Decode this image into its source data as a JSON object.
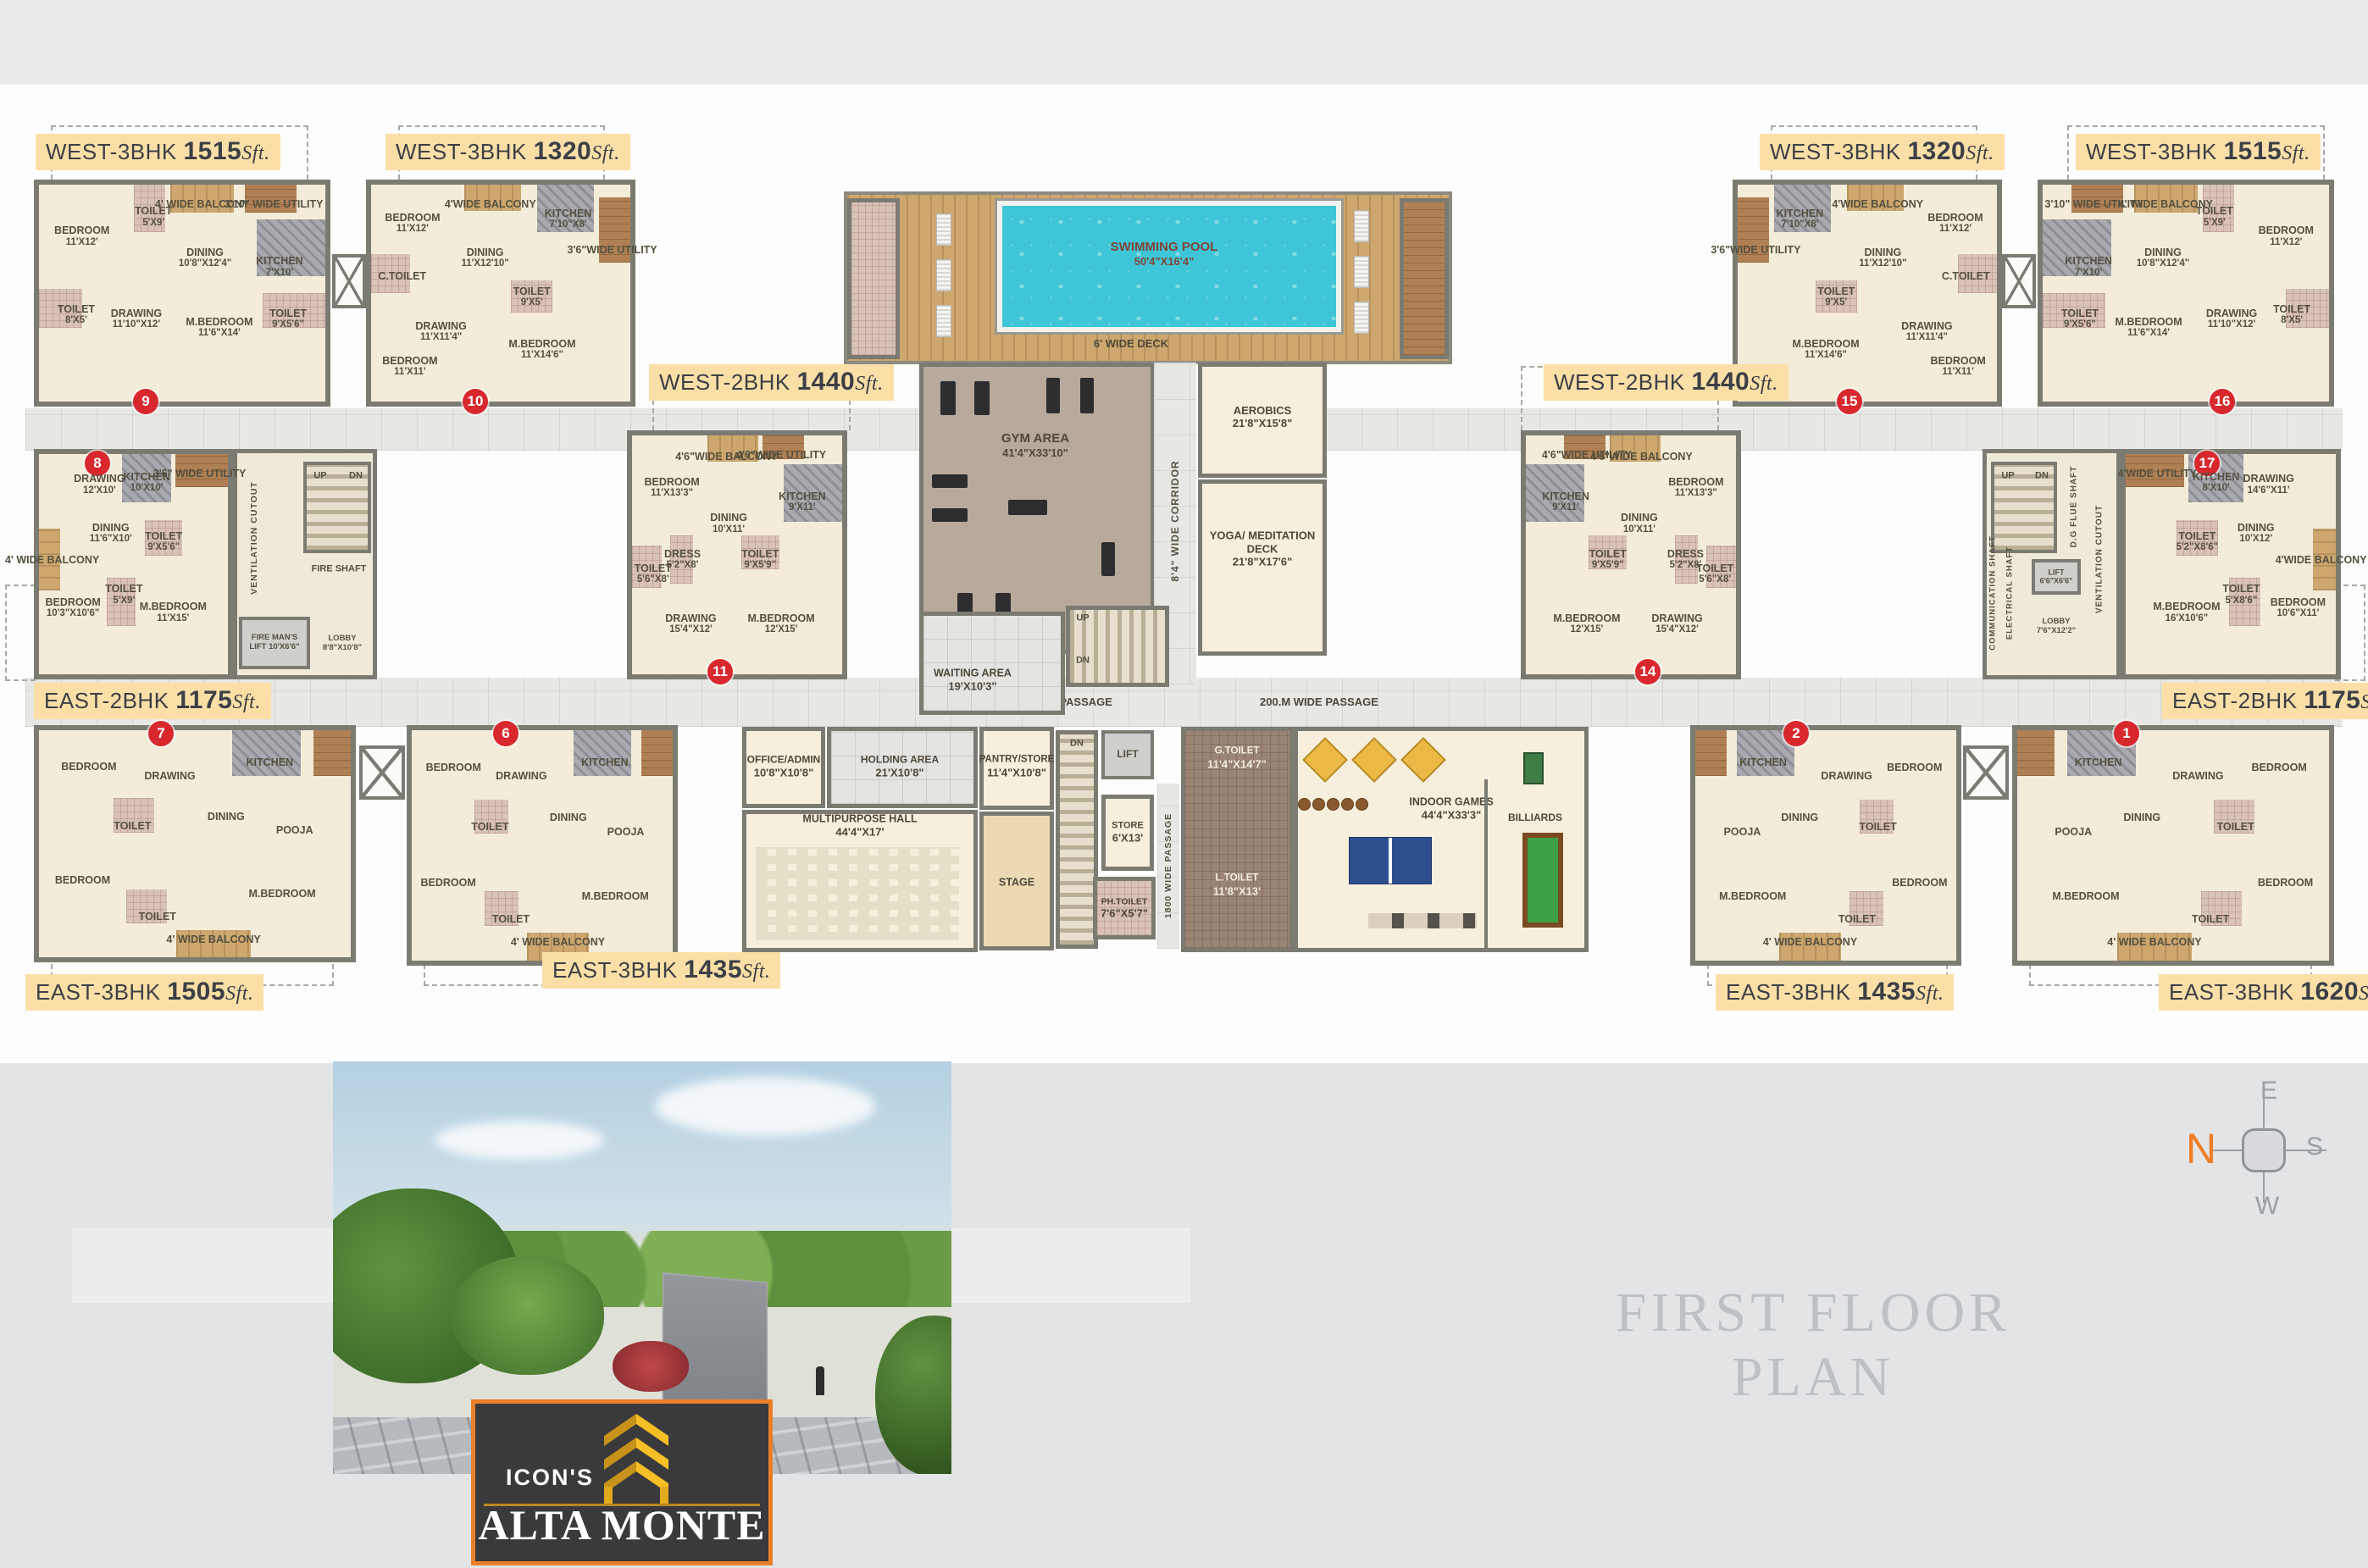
{
  "page": {
    "title": "FIRST FLOOR PLAN",
    "sft": "Sft."
  },
  "logo": {
    "brand": "ICON'S",
    "name": "ALTA MONTE"
  },
  "compass": {
    "n": "N",
    "e": "E",
    "s": "S",
    "w": "W"
  },
  "passages": {
    "left": "200.M WIDE PASSAGE",
    "right": "200.M WIDE PASSAGE",
    "corridor": "8'4\" WIDE CORRIDOR",
    "vertical": "1800 WIDE PASSAGE",
    "deck": "6' WIDE DECK",
    "up": "UP",
    "dn": "DN"
  },
  "amenities": {
    "pool": {
      "name": "SWIMMING POOL",
      "dim": "50'4\"X16'4\""
    },
    "gym": {
      "name": "GYM AREA",
      "dim": "41'4\"X33'10\""
    },
    "aerobics": {
      "name": "AEROBICS",
      "dim": "21'8\"X15'8\""
    },
    "yoga": {
      "name": "YOGA/ MEDITATION DECK",
      "dim": "21'8\"X17'6\""
    },
    "waiting": {
      "name": "WAITING AREA",
      "dim": "19'X10'3\""
    },
    "office": {
      "name": "OFFICE/ADMIN",
      "dim": "10'8\"X10'8\""
    },
    "holding": {
      "name": "HOLDING AREA",
      "dim": "21'X10'8\""
    },
    "hall": {
      "name": "MULTIPURPOSE HALL",
      "dim": "44'4\"X17'"
    },
    "pantry": {
      "name": "PANTRY/STORE",
      "dim": "11'4\"X10'8\""
    },
    "stage": {
      "name": "STAGE",
      "dim": ""
    },
    "lift": {
      "name": "LIFT",
      "dim": ""
    },
    "store": {
      "name": "STORE",
      "dim": "6'X13'"
    },
    "ph_toilet": {
      "name": "PH.TOILET",
      "dim": "7'6\"X5'7\""
    },
    "g_toilet": {
      "name": "G.TOILET",
      "dim": "11'4\"X14'7\""
    },
    "l_toilet": {
      "name": "L.TOILET",
      "dim": "11'8\"X13'"
    },
    "indoor_games": {
      "name": "INDOOR GAMES",
      "dim": "44'4\"X33'3\""
    },
    "billiards": {
      "name": "BILLIARDS",
      "dim": ""
    }
  },
  "cores": {
    "left": [
      "VENTILATION CUTOUT",
      "UP",
      "DN",
      "FIRE SHAFT",
      "FIRE MAN'S LIFT 10'X6'6\"",
      "LOBBY 8'8\"X10'8\""
    ],
    "right": [
      "D.G FLUE SHAFT",
      "UP",
      "DN",
      "VENTILATION CUTOUT",
      "COMMUNICATION SHAFT",
      "ELECTRICAL SHAFT",
      "LIFT 6'6\"X6'6\"",
      "LOBBY 7'6\"X12'2\""
    ]
  },
  "units": [
    {
      "id": "9",
      "label": "WEST-3BHK",
      "area": "1515",
      "number": "9",
      "rooms": [
        {
          "name": "BEDROOM",
          "dim": "11'X12'"
        },
        {
          "name": "TOILET",
          "dim": "5'X9'"
        },
        {
          "name": "4' WIDE BALCONY",
          "dim": ""
        },
        {
          "name": "3'10\" WIDE UTILITY",
          "dim": ""
        },
        {
          "name": "DINING",
          "dim": "10'8\"X12'4\""
        },
        {
          "name": "KITCHEN",
          "dim": "7'X10'"
        },
        {
          "name": "TOILET",
          "dim": "8'X5'"
        },
        {
          "name": "DRAWING",
          "dim": "11'10\"X12'"
        },
        {
          "name": "M.BEDROOM",
          "dim": "11'6\"X14'"
        },
        {
          "name": "TOILET",
          "dim": "9'X5'6\""
        }
      ]
    },
    {
      "id": "10",
      "label": "WEST-3BHK",
      "area": "1320",
      "number": "10",
      "rooms": [
        {
          "name": "BEDROOM",
          "dim": "11'X12'"
        },
        {
          "name": "C.TOILET",
          "dim": ""
        },
        {
          "name": "4'WIDE BALCONY",
          "dim": ""
        },
        {
          "name": "KITCHEN",
          "dim": "7'10\"X8'"
        },
        {
          "name": "3'6\"WIDE UTILITY",
          "dim": ""
        },
        {
          "name": "DINING",
          "dim": "11'X12'10\""
        },
        {
          "name": "TOILET",
          "dim": "9'X5'"
        },
        {
          "name": "DRAWING",
          "dim": "11'X11'4\""
        },
        {
          "name": "M.BEDROOM",
          "dim": "11'X14'6\""
        },
        {
          "name": "BEDROOM",
          "dim": "11'X11'"
        }
      ]
    },
    {
      "id": "15",
      "label": "WEST-3BHK",
      "area": "1320",
      "number": "15",
      "rooms": [
        {
          "name": "BEDROOM",
          "dim": "11'X12'"
        },
        {
          "name": "C.TOILET",
          "dim": ""
        },
        {
          "name": "4'WIDE BALCONY",
          "dim": ""
        },
        {
          "name": "KITCHEN",
          "dim": "7'10\"X8'"
        },
        {
          "name": "3'6\"WIDE UTILITY",
          "dim": ""
        },
        {
          "name": "DINING",
          "dim": "11'X12'10\""
        },
        {
          "name": "TOILET",
          "dim": "9'X5'"
        },
        {
          "name": "DRAWING",
          "dim": "11'X11'4\""
        },
        {
          "name": "M.BEDROOM",
          "dim": "11'X14'6\""
        },
        {
          "name": "BEDROOM",
          "dim": "11'X11'"
        }
      ]
    },
    {
      "id": "16",
      "label": "WEST-3BHK",
      "area": "1515",
      "number": "16",
      "rooms": [
        {
          "name": "BEDROOM",
          "dim": "11'X12'"
        },
        {
          "name": "TOILET",
          "dim": "5'X9'"
        },
        {
          "name": "4' WIDE BALCONY",
          "dim": ""
        },
        {
          "name": "3'10\" WIDE UTILITY",
          "dim": ""
        },
        {
          "name": "DINING",
          "dim": "10'8\"X12'4\""
        },
        {
          "name": "KITCHEN",
          "dim": "7'X10'"
        },
        {
          "name": "TOILET",
          "dim": "8'X5'"
        },
        {
          "name": "DRAWING",
          "dim": "11'10\"X12'"
        },
        {
          "name": "M.BEDROOM",
          "dim": "11'6\"X14'"
        },
        {
          "name": "TOILET",
          "dim": "9'X5'6\""
        }
      ]
    },
    {
      "id": "8",
      "label": "EAST-2BHK",
      "area": "1175",
      "number": "8",
      "rooms": [
        {
          "name": "DRAWING",
          "dim": "12'X10'"
        },
        {
          "name": "KITCHEN",
          "dim": "10'X10'"
        },
        {
          "name": "3'6\" WIDE UTILITY",
          "dim": ""
        },
        {
          "name": "DINING",
          "dim": "11'6\"X10'"
        },
        {
          "name": "TOILET",
          "dim": "9'X5'6\""
        },
        {
          "name": "4' WIDE BALCONY",
          "dim": ""
        },
        {
          "name": "BEDROOM",
          "dim": "10'3\"X10'6\""
        },
        {
          "name": "TOILET",
          "dim": "5'X9'"
        },
        {
          "name": "M.BEDROOM",
          "dim": "11'X15'"
        }
      ]
    },
    {
      "id": "17",
      "label": "EAST-2BHK",
      "area": "1175",
      "number": "17",
      "rooms": [
        {
          "name": "DRAWING",
          "dim": "14'6\"X11'"
        },
        {
          "name": "KITCHEN",
          "dim": "8'X10'"
        },
        {
          "name": "4'WIDE UTILITY",
          "dim": ""
        },
        {
          "name": "DINING",
          "dim": "10'X12'"
        },
        {
          "name": "TOILET",
          "dim": "5'2\"X8'6\""
        },
        {
          "name": "4'WIDE BALCONY",
          "dim": ""
        },
        {
          "name": "BEDROOM",
          "dim": "10'6\"X11'"
        },
        {
          "name": "TOILET",
          "dim": "5'X8'6\""
        },
        {
          "name": "M.BEDROOM",
          "dim": "16'X10'6\""
        }
      ]
    },
    {
      "id": "11",
      "label": "WEST-2BHK",
      "area": "1440",
      "number": "11",
      "rooms": [
        {
          "name": "BEDROOM",
          "dim": "11'X13'3\""
        },
        {
          "name": "4'6\"WIDE BALCONY",
          "dim": ""
        },
        {
          "name": "4'6\"WIDE UTILITY",
          "dim": ""
        },
        {
          "name": "KITCHEN",
          "dim": "9'X11'"
        },
        {
          "name": "DINING",
          "dim": "10'X11'"
        },
        {
          "name": "DRESS",
          "dim": "5'2\"X8'"
        },
        {
          "name": "TOILET",
          "dim": "5'6\"X8'"
        },
        {
          "name": "TOILET",
          "dim": "9'X5'9\""
        },
        {
          "name": "DRAWING",
          "dim": "15'4\"X12'"
        },
        {
          "name": "M.BEDROOM",
          "dim": "12'X15'"
        }
      ]
    },
    {
      "id": "14",
      "label": "WEST-2BHK",
      "area": "1440",
      "number": "14",
      "rooms": [
        {
          "name": "BEDROOM",
          "dim": "11'X13'3\""
        },
        {
          "name": "4'6\"WIDE BALCONY",
          "dim": ""
        },
        {
          "name": "4'6\"WIDE UTILITY",
          "dim": ""
        },
        {
          "name": "KITCHEN",
          "dim": "9'X11'"
        },
        {
          "name": "DINING",
          "dim": "10'X11'"
        },
        {
          "name": "DRESS",
          "dim": "5'2\"X8'"
        },
        {
          "name": "TOILET",
          "dim": "5'6\"X8'"
        },
        {
          "name": "TOILET",
          "dim": "9'X5'9\""
        },
        {
          "name": "DRAWING",
          "dim": "15'4\"X12'"
        },
        {
          "name": "M.BEDROOM",
          "dim": "12'X15'"
        }
      ]
    },
    {
      "id": "7",
      "label": "EAST-3BHK",
      "area": "1505",
      "number": "7",
      "rooms": [
        {
          "name": "BEDROOM",
          "dim": ""
        },
        {
          "name": "DRAWING",
          "dim": ""
        },
        {
          "name": "KITCHEN",
          "dim": ""
        },
        {
          "name": "DINING",
          "dim": ""
        },
        {
          "name": "TOILET",
          "dim": ""
        },
        {
          "name": "BEDROOM",
          "dim": ""
        },
        {
          "name": "TOILET",
          "dim": ""
        },
        {
          "name": "4' WIDE BALCONY",
          "dim": ""
        },
        {
          "name": "M.BEDROOM",
          "dim": ""
        },
        {
          "name": "POOJA",
          "dim": ""
        }
      ]
    },
    {
      "id": "6",
      "label": "EAST-3BHK",
      "area": "1435",
      "number": "6",
      "rooms": [
        {
          "name": "BEDROOM",
          "dim": ""
        },
        {
          "name": "DRAWING",
          "dim": ""
        },
        {
          "name": "KITCHEN",
          "dim": ""
        },
        {
          "name": "DINING",
          "dim": ""
        },
        {
          "name": "TOILET",
          "dim": ""
        },
        {
          "name": "BEDROOM",
          "dim": ""
        },
        {
          "name": "TOILET",
          "dim": ""
        },
        {
          "name": "4' WIDE BALCONY",
          "dim": ""
        },
        {
          "name": "M.BEDROOM",
          "dim": ""
        },
        {
          "name": "POOJA",
          "dim": ""
        }
      ]
    },
    {
      "id": "2",
      "label": "EAST-3BHK",
      "area": "1435",
      "number": "2",
      "rooms": [
        {
          "name": "BEDROOM",
          "dim": ""
        },
        {
          "name": "DRAWING",
          "dim": ""
        },
        {
          "name": "KITCHEN",
          "dim": ""
        },
        {
          "name": "DINING",
          "dim": ""
        },
        {
          "name": "TOILET",
          "dim": ""
        },
        {
          "name": "BEDROOM",
          "dim": ""
        },
        {
          "name": "TOILET",
          "dim": ""
        },
        {
          "name": "4' WIDE BALCONY",
          "dim": ""
        },
        {
          "name": "M.BEDROOM",
          "dim": ""
        },
        {
          "name": "POOJA",
          "dim": ""
        }
      ]
    },
    {
      "id": "1",
      "label": "EAST-3BHK",
      "area": "1620",
      "number": "1",
      "rooms": [
        {
          "name": "BEDROOM",
          "dim": ""
        },
        {
          "name": "DRAWING",
          "dim": ""
        },
        {
          "name": "KITCHEN",
          "dim": ""
        },
        {
          "name": "DINING",
          "dim": ""
        },
        {
          "name": "TOILET",
          "dim": ""
        },
        {
          "name": "BEDROOM",
          "dim": ""
        },
        {
          "name": "TOILET",
          "dim": ""
        },
        {
          "name": "4' WIDE BALCONY",
          "dim": ""
        },
        {
          "name": "M.BEDROOM",
          "dim": ""
        },
        {
          "name": "POOJA",
          "dim": ""
        }
      ]
    }
  ]
}
